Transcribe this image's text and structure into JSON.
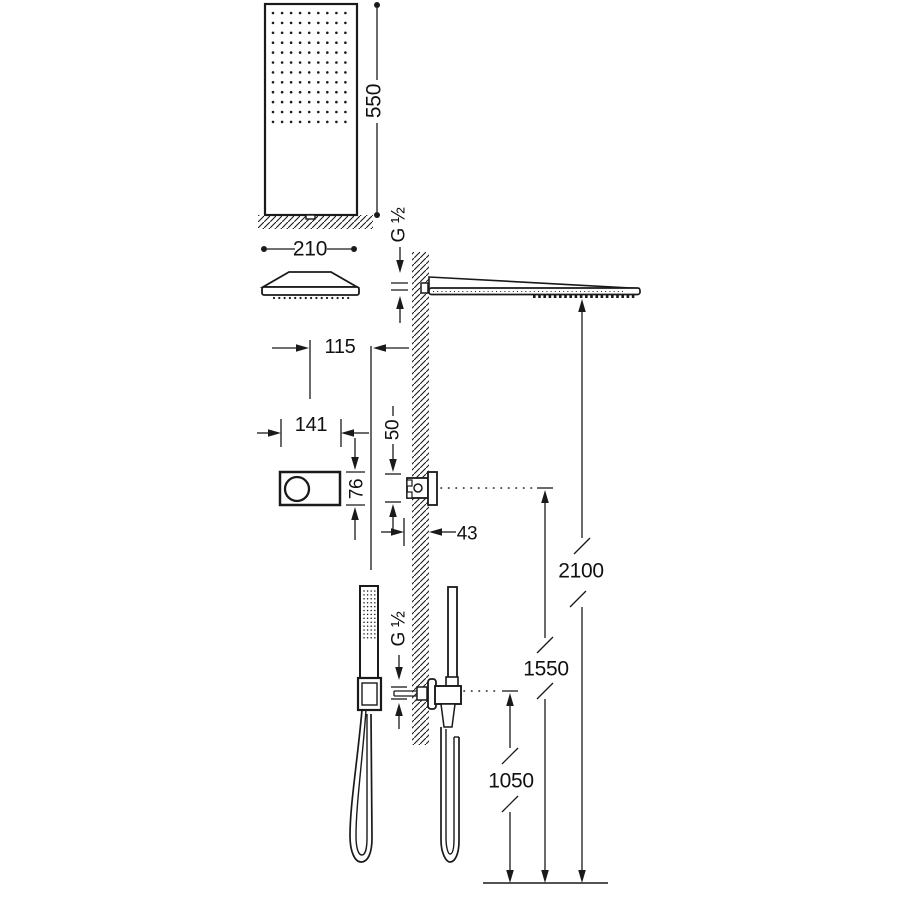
{
  "drawing": {
    "kind": "shower-system-installation-dimension-diagram",
    "background": "#ffffff",
    "line_color": "#1a1a1a",
    "labels": {
      "overhead_shower_height": "550",
      "overhead_shower_width": "210",
      "wall_arm_connection": "G ½",
      "arm_center_offset": "115",
      "control_unit_width": "141",
      "outlet_offset": "50",
      "control_unit_height": "76",
      "recess_depth": "43",
      "hand_shower_connection": "G ½",
      "mount_height_overhead": "2100",
      "mount_height_control": "1550",
      "mount_height_hand_shower": "1050"
    }
  }
}
